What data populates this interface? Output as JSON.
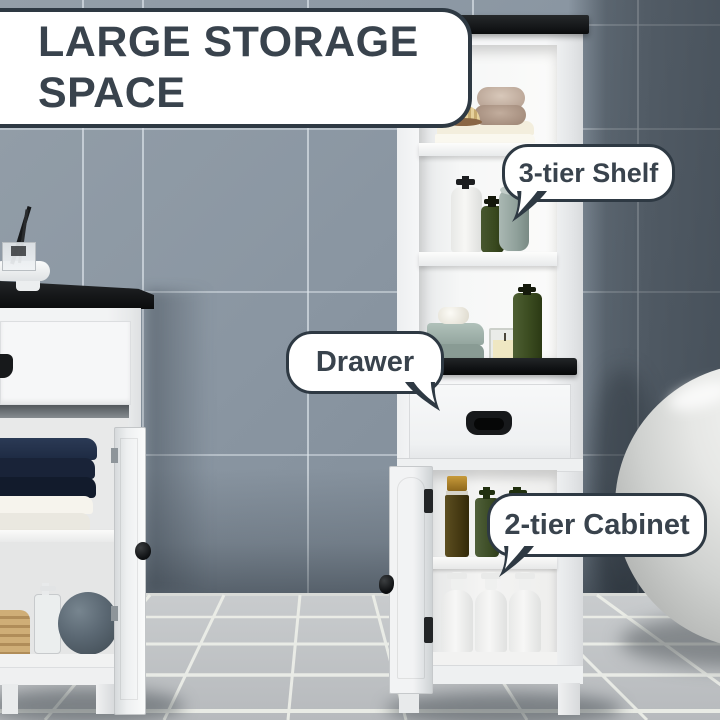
{
  "title_badge": {
    "line1": "LARGE STORAGE",
    "line2": "SPACE"
  },
  "callouts": {
    "shelf": {
      "label": "3-tier Shelf"
    },
    "drawer": {
      "label": "Drawer"
    },
    "cabinet": {
      "label": "2-tier Cabinet"
    }
  },
  "palette": {
    "wall_light": "#8a96a2",
    "wall_dark": "#5d666e",
    "floor": "#c6c9cc",
    "grout": "#eceee8",
    "furniture_white": "#f4f5f6",
    "furniture_top_black": "#17191b",
    "headline_text": "#39434d",
    "bubble_border": "#2e3943",
    "towel_navy": "#192338",
    "towel_sage": "#9fb1aa",
    "towel_taupe": "#bfae9f",
    "bottle_green": "#42522e",
    "bottle_amber": "#57491c",
    "basket_tan": "#c5a672",
    "loofah_gray": "#5b6873",
    "bathtub": "#d8d9d7"
  },
  "scene": {
    "background": {
      "wall": "blue-gray tile wall",
      "floor": "light gray tile floor",
      "right_fixture": "white freestanding bathtub"
    },
    "furniture": [
      {
        "name": "tall linen tower cabinet",
        "features": [
          "black top",
          "3 open shelves",
          "middle black counter",
          "drawer with black handle",
          "2-tier cabinet with open door"
        ]
      },
      {
        "name": "bathroom vanity cabinet",
        "features": [
          "black top",
          "drawer",
          "open shelf with towels",
          "open door with black knob"
        ]
      }
    ],
    "props": [
      "cream folded towels",
      "taupe rolled towels",
      "wooden brush",
      "white lotion pump bottle",
      "green lotion pump bottles",
      "rolled gray towel",
      "sage folded towels with soap bar",
      "candle in glass",
      "amber spray bottle",
      "three white pump bottles",
      "reed diffuser on round tray",
      "navy folded towels",
      "white folded towels",
      "wicker basket",
      "clear soap dispenser",
      "gray loofah"
    ]
  }
}
